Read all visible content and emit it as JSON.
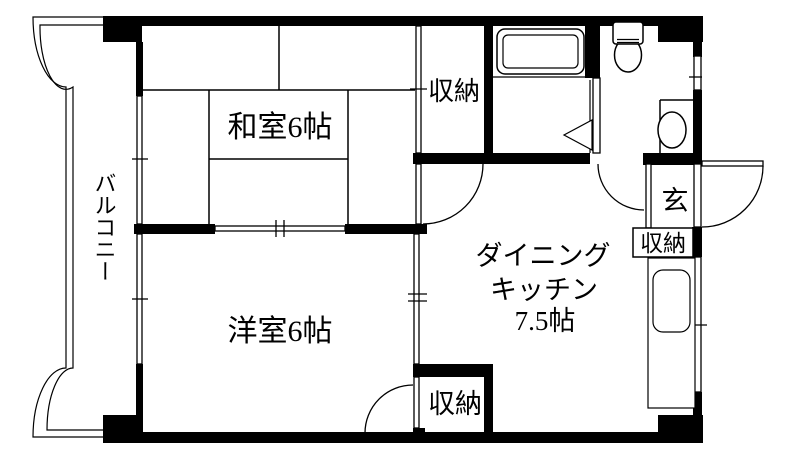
{
  "floor_plan": {
    "type": "apartment-madori",
    "colors": {
      "wall": "#000000",
      "background": "#ffffff",
      "line": "#000000"
    },
    "rooms": {
      "japanese_room": {
        "label": "和室6帖"
      },
      "western_room": {
        "label": "洋室6帖"
      },
      "dining_kitchen": {
        "label_line1": "ダイニング",
        "label_line2": "キッチン",
        "label_line3": "7.5帖"
      },
      "balcony": {
        "label": "バルコニー"
      },
      "entrance": {
        "label": "玄"
      }
    },
    "storage": {
      "top_closet": {
        "label": "収納"
      },
      "entrance_closet": {
        "label": "収納"
      },
      "bottom_closet": {
        "label": "収納"
      }
    }
  }
}
